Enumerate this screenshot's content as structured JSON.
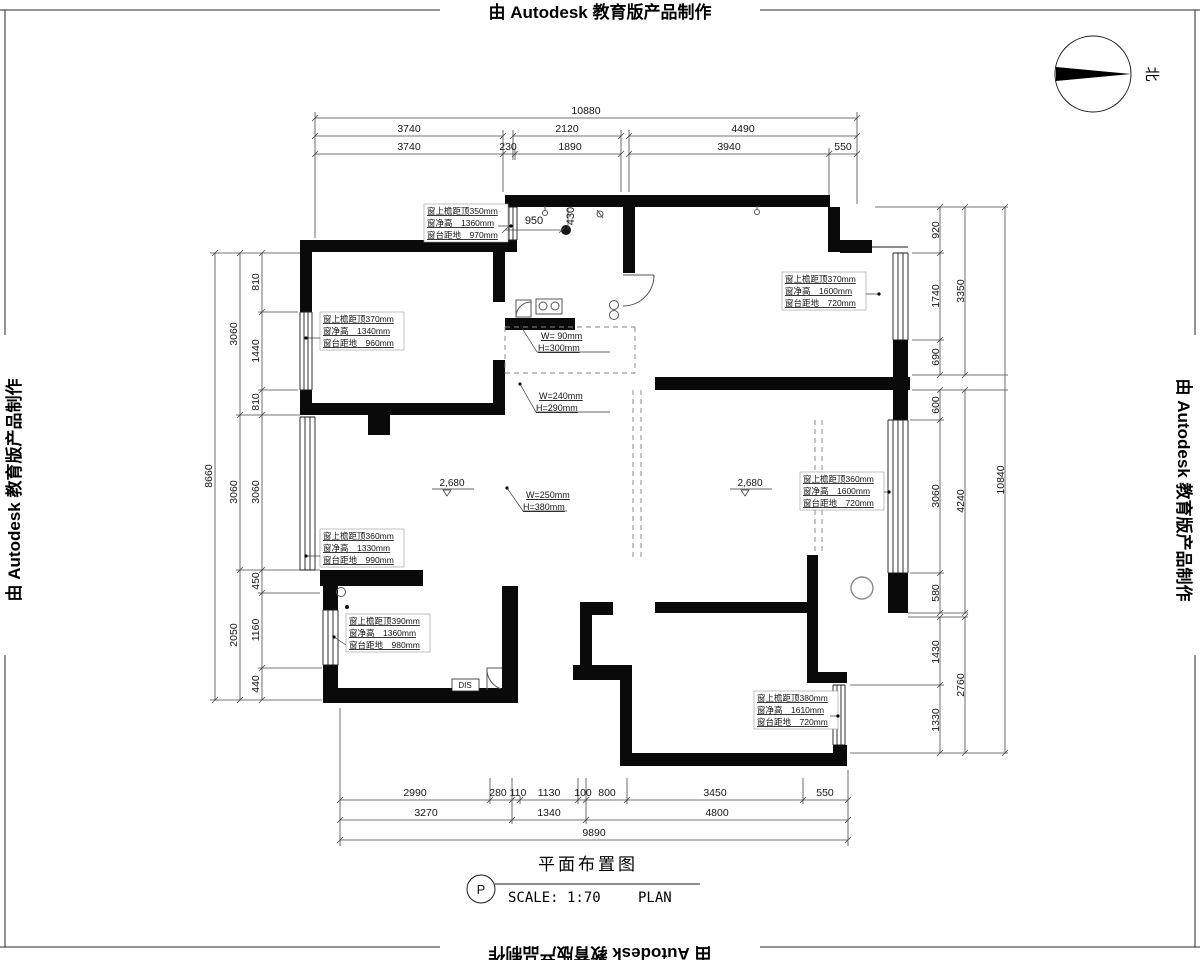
{
  "stamps": {
    "text": "由 Autodesk 教育版产品制作"
  },
  "compass": {
    "north": "北"
  },
  "title_block": {
    "name": "平面布置图",
    "tag": "P",
    "scale": "SCALE: 1:70",
    "plan": "PLAN"
  },
  "dims": {
    "top": {
      "overall": "10880",
      "row2": [
        "3740",
        "2120",
        "4490"
      ],
      "row3": [
        "3740",
        "230",
        "1890",
        "3940",
        "550"
      ]
    },
    "bottom": {
      "row1": [
        "2990",
        "280",
        "110",
        "1130",
        "100",
        "800",
        "3450",
        "550"
      ],
      "row2": [
        "3270",
        "1340",
        "4800"
      ],
      "overall": "9890"
    },
    "left": {
      "overall": "8660",
      "mid": [
        "3060",
        "3060",
        "2050"
      ],
      "inner": [
        "810",
        "1440",
        "810",
        "3060",
        "450",
        "1160",
        "440"
      ]
    },
    "right": {
      "inner": [
        "920",
        "1740",
        "690",
        "600",
        "3060",
        "580",
        "1430",
        "1330"
      ],
      "mid": [
        "3350",
        "4240",
        "2760"
      ],
      "overall": "10840"
    },
    "interior": {
      "a": "950",
      "b": "430"
    }
  },
  "window_notes": [
    {
      "l1": "窗上檐距顶350mm",
      "l2": "窗净高　1360mm",
      "l3": "窗台距地　970mm"
    },
    {
      "l1": "窗上檐距顶370mm",
      "l2": "窗净高　1340mm",
      "l3": "窗台距地　960mm"
    },
    {
      "l1": "窗上檐距顶370mm",
      "l2": "窗净高　1600mm",
      "l3": "窗台距地　720mm"
    },
    {
      "l1": "窗上檐距顶360mm",
      "l2": "窗净高　1600mm",
      "l3": "窗台距地　720mm"
    },
    {
      "l1": "窗上檐距顶360mm",
      "l2": "窗净高　1330mm",
      "l3": "窗台距地　990mm"
    },
    {
      "l1": "窗上檐距顶390mm",
      "l2": "窗净高　1360mm",
      "l3": "窗台距地　980mm"
    },
    {
      "l1": "窗上檐距顶380mm",
      "l2": "窗净高　1610mm",
      "l3": "窗台距地　720mm"
    }
  ],
  "beam_notes": [
    {
      "w": "W= 90mm",
      "h": "H=300mm"
    },
    {
      "w": "W=240mm",
      "h": "H=290mm"
    },
    {
      "w": "W=250mm",
      "h": "H=380mm"
    }
  ],
  "levels": {
    "a": "2,680",
    "b": "2,680"
  },
  "labels": {
    "dis": "DIS"
  }
}
